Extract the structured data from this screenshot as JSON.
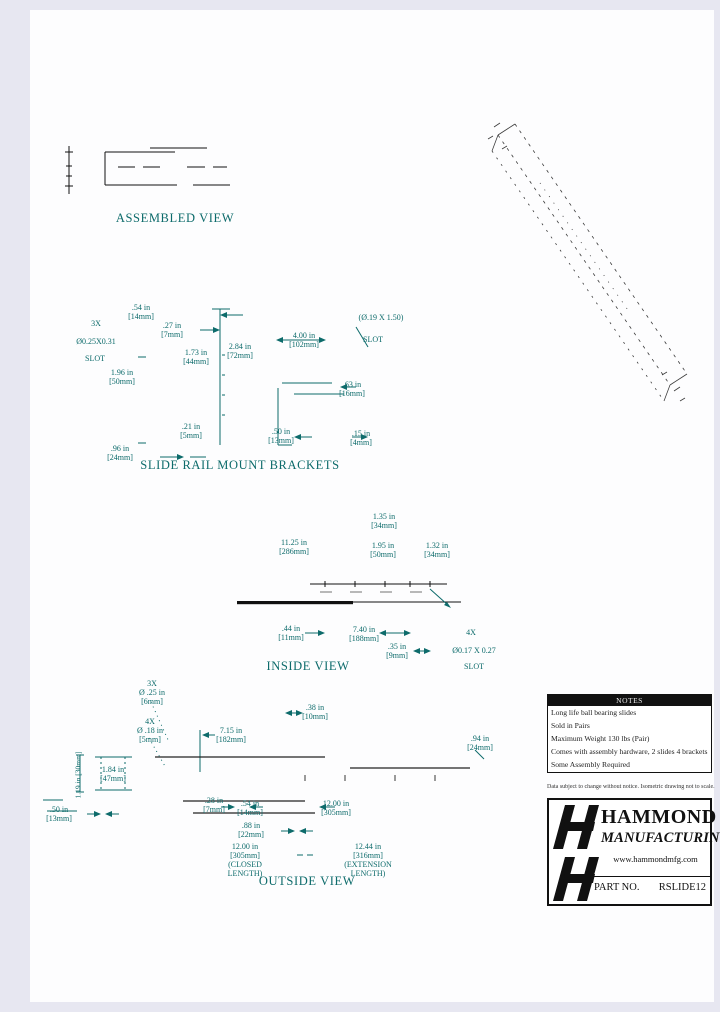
{
  "colors": {
    "dimension_teal": "#0d6b6b",
    "line_black": "#111111"
  },
  "views": {
    "assembled": {
      "title": "ASSEMBLED VIEW"
    },
    "brackets": {
      "title": "SLIDE RAIL MOUNT BRACKETS",
      "dims": {
        "top_54": ".54 in\n[14mm]",
        "qty_3x": "3X",
        "slot_025": "Ø0.25X0.31",
        "slot_025_word": "SLOT",
        "d27": ".27 in\n[7mm]",
        "d173": "1.73 in\n[44mm]",
        "d284": "2.84 in\n[72mm]",
        "d400": "4.00 in\n[102mm]",
        "slot_019": "(Ø.19 X 1.50)",
        "slot_019_word": "SLOT",
        "d63": ".63 in\n[16mm]",
        "d196": "1.96 in\n[50mm]",
        "d21": ".21 in\n[5mm]",
        "d50": ".50 in\n[13mm]",
        "d15": ".15 in\n[4mm]",
        "d96": ".96 in\n[24mm]"
      }
    },
    "inside": {
      "title": "INSIDE VIEW",
      "dims": {
        "d135": "1.35 in\n[34mm]",
        "d1125": "11.25 in\n[286mm]",
        "d195": "1.95 in\n[50mm]",
        "d132": "1.32 in\n[34mm]",
        "d44": ".44 in\n[11mm]",
        "d740": "7.40 in\n[188mm]",
        "d35": ".35 in\n[9mm]",
        "qty_4x": "4X",
        "slot_017": "Ø0.17 X 0.27",
        "slot_017_word": "SLOT"
      }
    },
    "outside": {
      "title": "OUTSIDE VIEW",
      "dims": {
        "holes_3x": "3X\nØ .25 in\n[6mm]",
        "holes_4x": "4X\nØ .18 in\n[5mm]",
        "d38": ".38 in\n[10mm]",
        "d715": "7.15 in\n[182mm]",
        "d94": ".94 in\n[24mm]",
        "d184": "1.84 in\n[47mm]",
        "d119": "1.19 in [30mm]",
        "d50": ".50 in\n[13mm]",
        "d28": ".28 in\n[7mm]",
        "d54": ".54 in\n[14mm]",
        "d1200": "12.00 in\n[305mm]",
        "d88": ".88 in\n[22mm]",
        "closed": "12.00 in\n[305mm]\n(CLOSED\nLENGTH)",
        "extension": "12.44 in\n[316mm]\n(EXTENSION\nLENGTH)"
      }
    }
  },
  "notes": {
    "title": "NOTES",
    "lines": [
      "Long life ball bearing slides",
      "Sold in Pairs",
      "Maximum Weight 130 lbs (Pair)",
      "Comes with assembly hardware, 2 slides 4 brackets",
      "Some Assembly Required"
    ]
  },
  "disclaimer": "Data subject to change without notice. Isometric drawing not to scale.",
  "titleblock": {
    "company_line1": "HAMMOND",
    "company_line2": "MANUFACTURING",
    "company_suffix": "LTD.",
    "website": "www.hammondmfg.com",
    "part_label": "PART NO.",
    "part_number": "RSLIDE12"
  }
}
